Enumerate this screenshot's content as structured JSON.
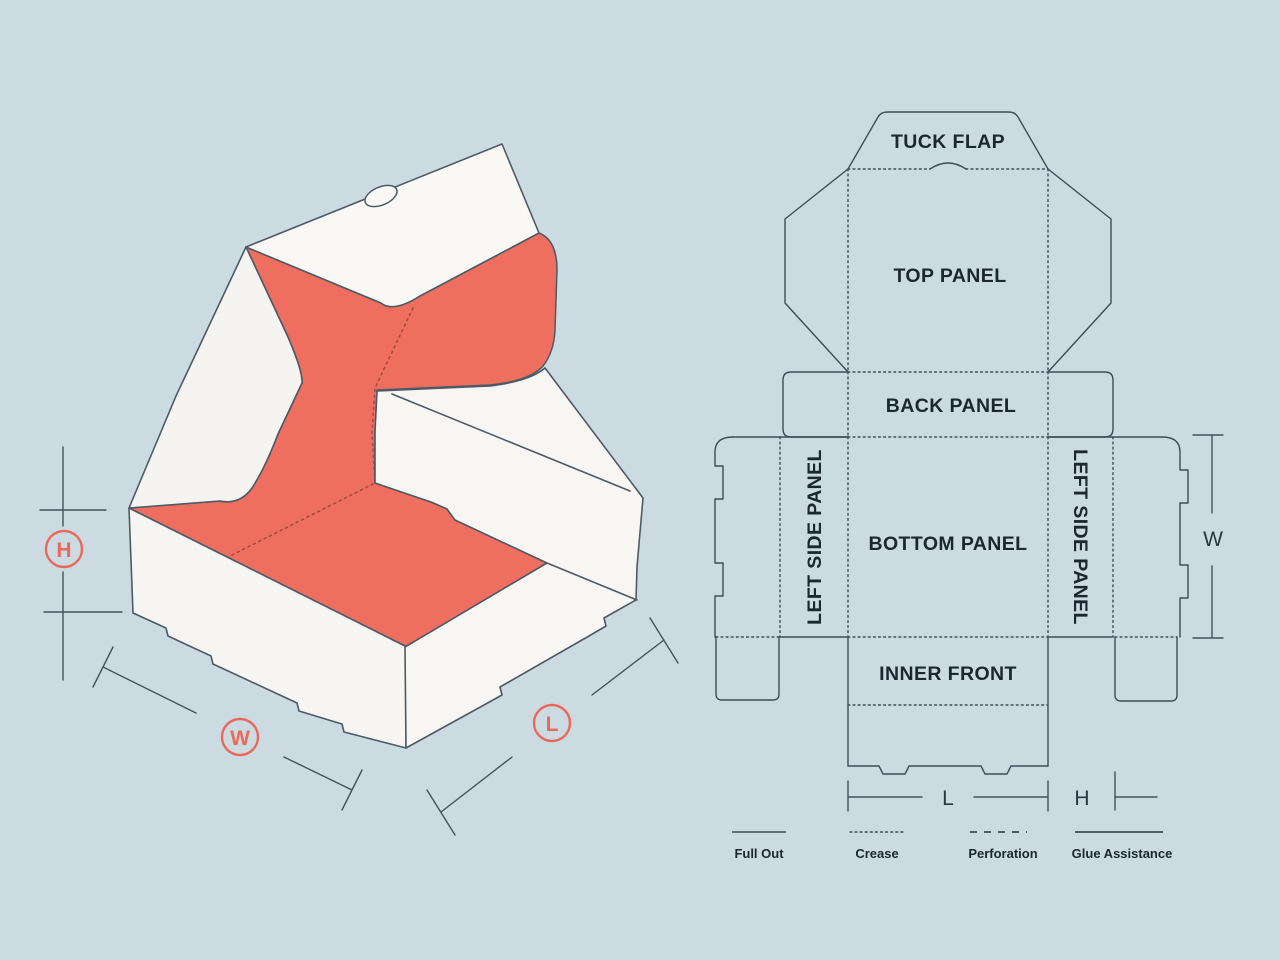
{
  "colors": {
    "background": "#ccdbe2",
    "dieline_stroke": "#3e4c59",
    "box_outline": "#4d5a66",
    "box_white": "#f8f7f4",
    "coral_interior": "#ee6e5f",
    "coral_crease": "#a84a40",
    "accent_circle": "#e96a5b",
    "label_text": "#1d2731"
  },
  "dims": {
    "length": "L",
    "width": "W",
    "height": "H"
  },
  "dieline": {
    "panels": [
      {
        "id": "tuck-flap",
        "label": "TUCK FLAP"
      },
      {
        "id": "top-panel",
        "label": "TOP PANEL"
      },
      {
        "id": "back-panel",
        "label": "BACK PANEL"
      },
      {
        "id": "left-side-panel",
        "label": "LEFT SIDE PANEL"
      },
      {
        "id": "bottom-panel",
        "label": "BOTTOM PANEL"
      },
      {
        "id": "right-side-panel",
        "label": "LEFT SIDE PANEL"
      },
      {
        "id": "inner-front",
        "label": "INNER FRONT"
      }
    ]
  },
  "legend": {
    "items": [
      {
        "label": "Full Out",
        "style": "solid"
      },
      {
        "label": "Crease",
        "style": "dotted"
      },
      {
        "label": "Perforation",
        "style": "dashed"
      },
      {
        "label": "Glue Assistance",
        "style": "solid"
      }
    ]
  }
}
